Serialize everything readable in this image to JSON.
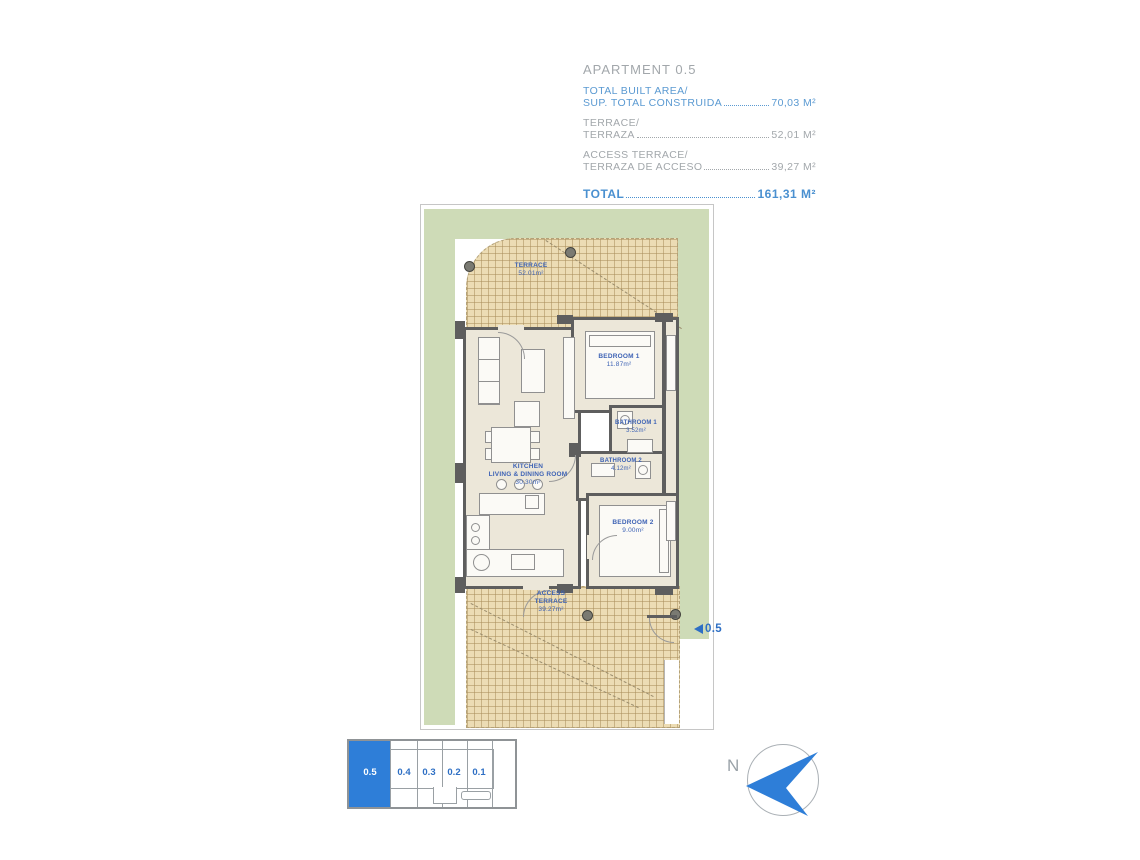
{
  "header": {
    "title": "APARTMENT 0.5",
    "rows": [
      {
        "line1": "TOTAL BUILT AREA/",
        "line2": "SUP. TOTAL CONSTRUIDA",
        "value": "70,03 M²"
      },
      {
        "line1": "TERRACE/",
        "line2": "TERRAZA",
        "value": "52,01 M²"
      },
      {
        "line1": "ACCESS TERRACE/",
        "line2": "TERRAZA DE ACCESO",
        "value": "39,27 M²"
      }
    ],
    "total_label": "TOTAL",
    "total_value": "161,31 M²"
  },
  "plan": {
    "terrace": {
      "name": "TERRACE",
      "area": "52.01m²"
    },
    "bedroom1": {
      "name": "BEDROOM 1",
      "area": "11.87m²"
    },
    "bathroom1": {
      "name": "BATHROOM 1",
      "area": "3.52m²"
    },
    "kitchen": {
      "name1": "KITCHEN",
      "name2": "LIVING & DINING ROOM",
      "area": "30.30m²"
    },
    "bathroom2": {
      "name": "BATHROOM 2",
      "area": "4.12m²"
    },
    "bedroom2": {
      "name": "BEDROOM 2",
      "area": "9.00m²"
    },
    "access_terrace": {
      "name1": "ACCESS",
      "name2": "TERRACE",
      "area": "39.27m²"
    },
    "entrance_label": "0.5"
  },
  "key_plan": {
    "units": [
      {
        "label": "0.5",
        "selected": true
      },
      {
        "label": "0.4",
        "selected": false
      },
      {
        "label": "0.3",
        "selected": false
      },
      {
        "label": "0.2",
        "selected": false
      },
      {
        "label": "0.1",
        "selected": false
      }
    ]
  },
  "compass": {
    "label": "N"
  },
  "colors": {
    "accent_blue": "#2e7ed8",
    "plan_label_blue": "#3e63b5",
    "header_blue": "#5b9ad2",
    "gray_text": "#a2a7ab",
    "garden_green": "#cedbb7",
    "tile_beige": "#ecdcb4",
    "wall_gray": "#5e5e5e"
  }
}
